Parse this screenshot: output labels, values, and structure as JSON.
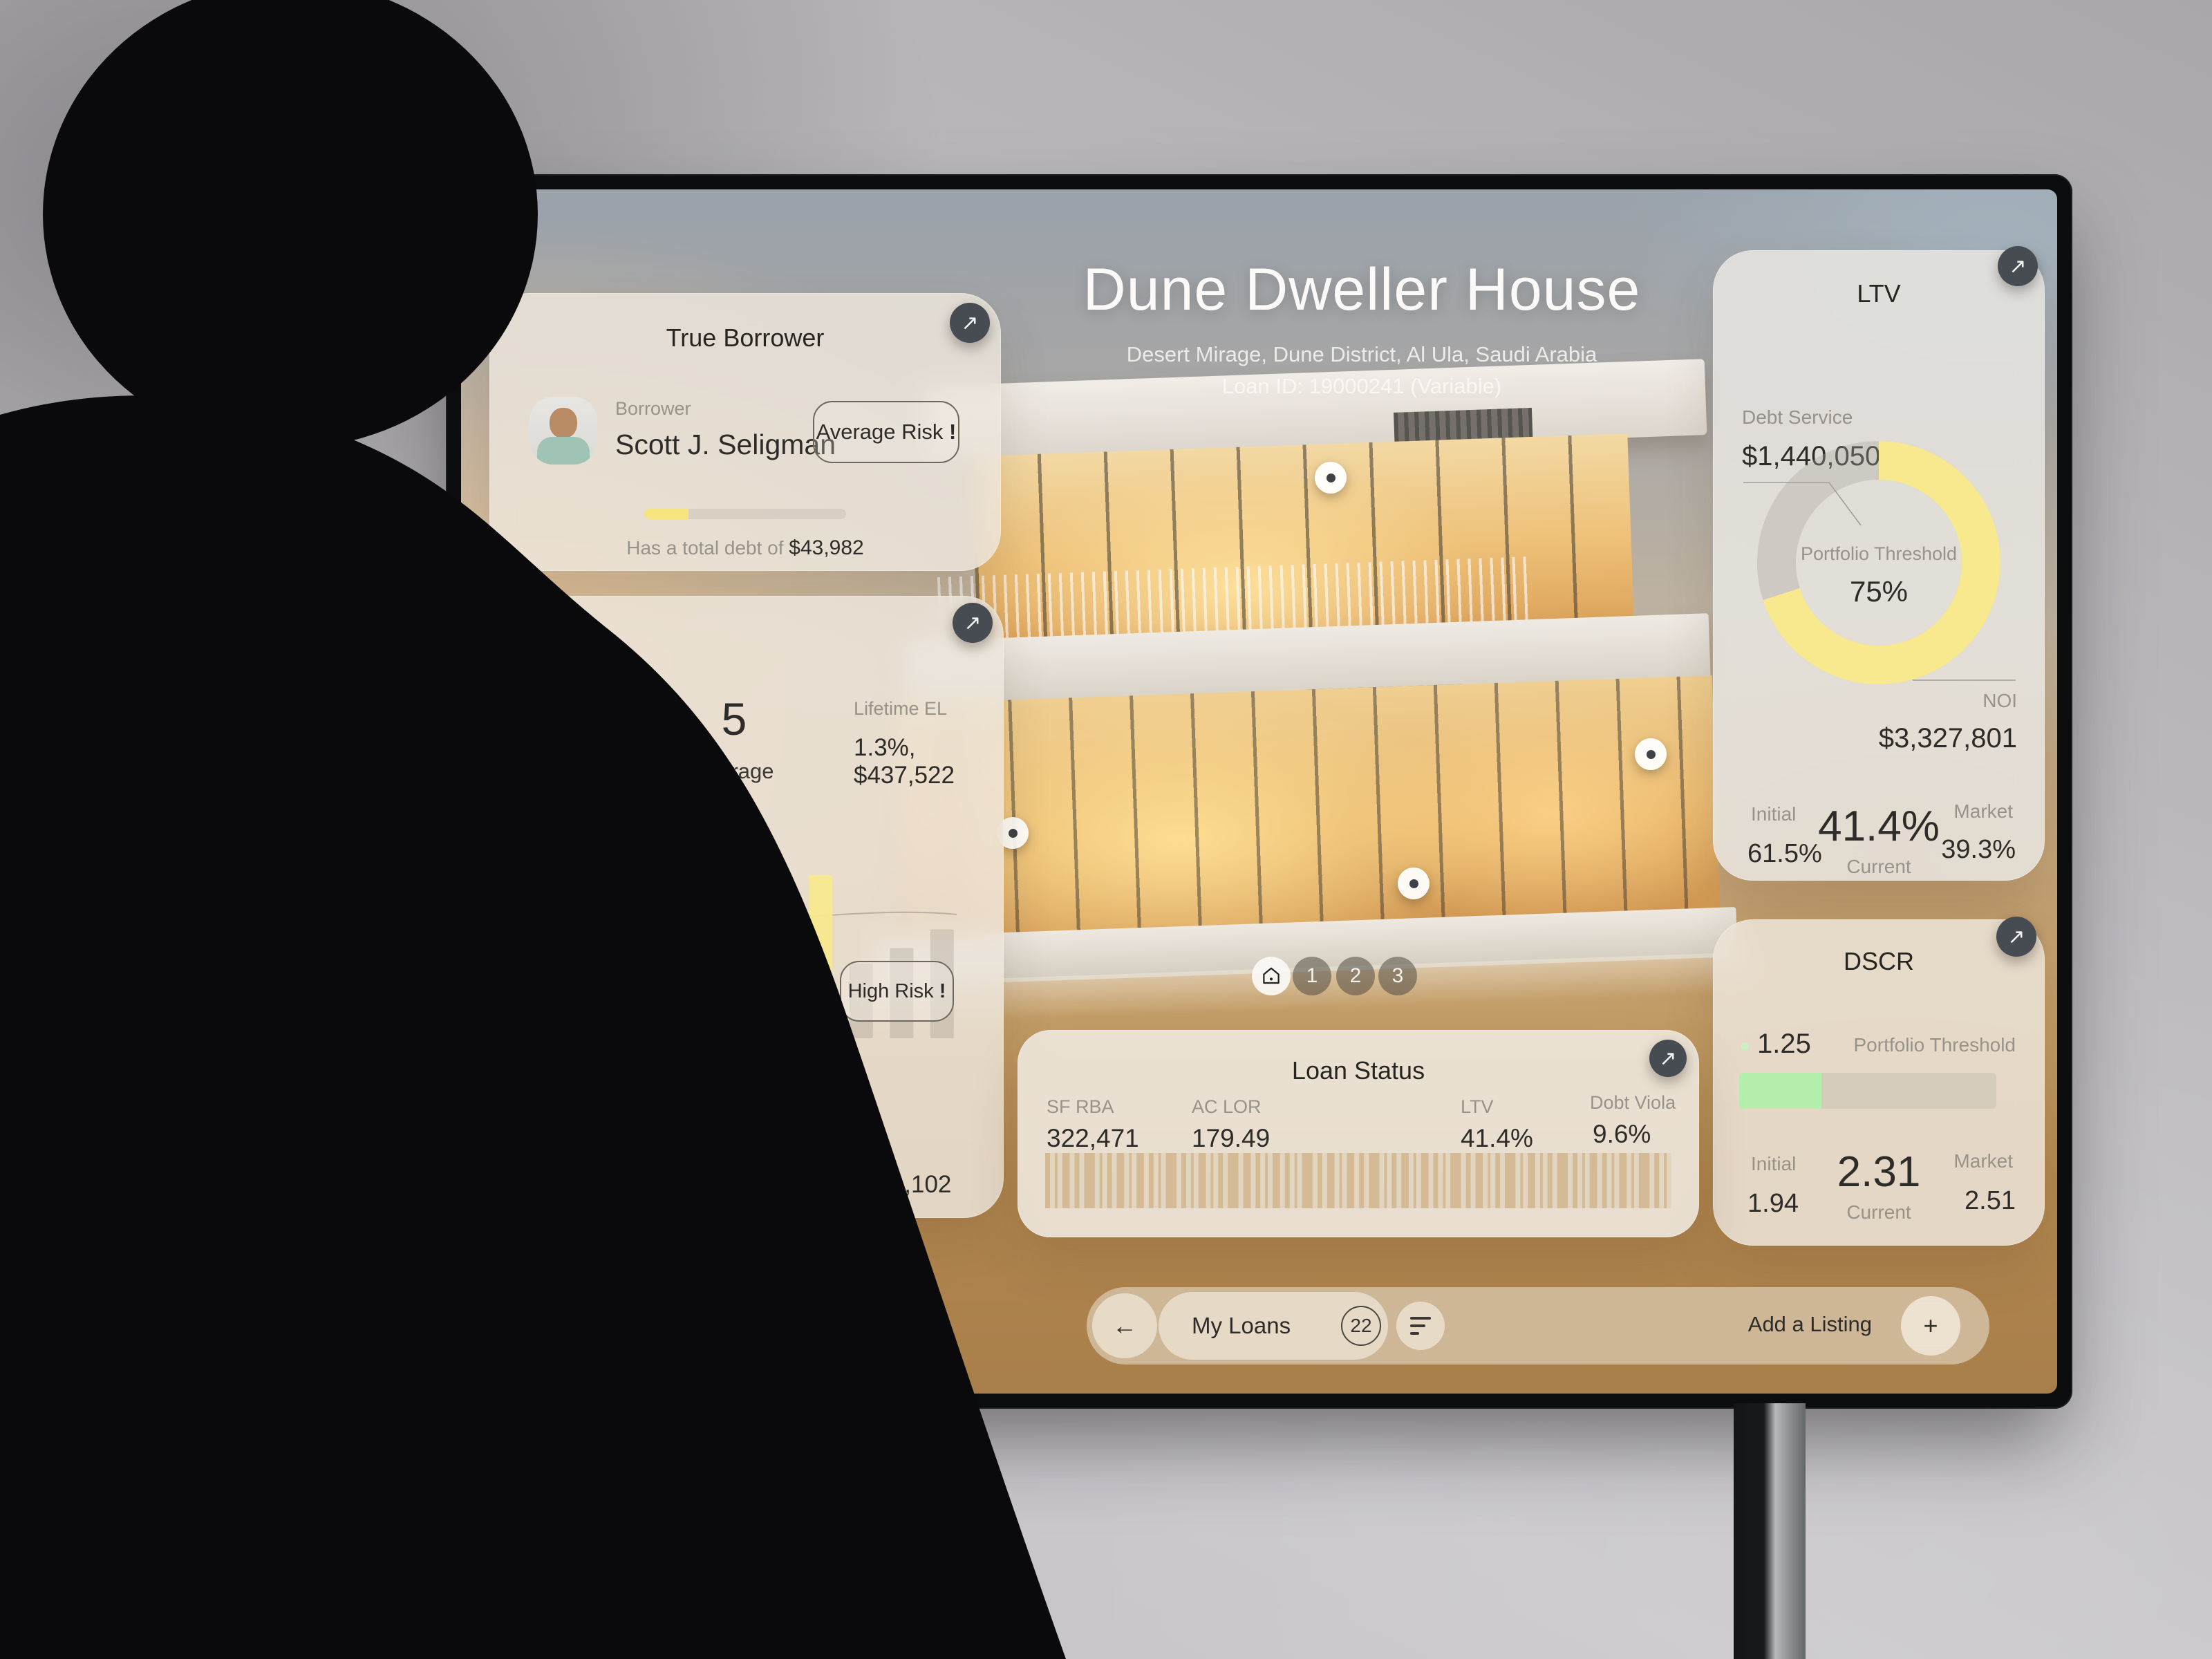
{
  "colors": {
    "accent_yellow": "#f8e88e",
    "accent_green": "#b5efae",
    "button_dark": "#474b52",
    "bar_gray": "#8e867a",
    "barcode_tan": "#c49c63"
  },
  "header": {
    "title": "Dune Dweller House",
    "address": "Desert Mirage, Dune District, Al Ula, Saudi Arabia",
    "loan_id": "Loan ID: 19000241 (Variable)"
  },
  "borrower_card": {
    "title": "True Borrower",
    "role_label": "Borrower",
    "name": "Scott J. Seligman",
    "risk_badge": "Average Risk",
    "risk_mark": "!",
    "progress_pct": 22,
    "debt_text_prefix": "Has a total debt of",
    "debt_value": "$43,982"
  },
  "risk_card": {
    "rating_label": "CoStar Risk Rating",
    "rating_value": "4 - Low",
    "score_value": "5",
    "score_label": "Average",
    "scenario_base_label": "Base Scenario",
    "lifetime_el_label": "Lifetime EL",
    "base_lifetime_el_value": "1.3%, $437,522",
    "high_risk_badge": "High Risk",
    "high_risk_mark": "!",
    "scenario_stress_label": "Stress Scenario",
    "stress_lifetime_el_label": "Lifetime EL",
    "stress_lifetime_el_value": "3.2%, $1,101,102"
  },
  "chart_data": {
    "type": "bar",
    "title": "Base Scenario loss distribution",
    "categories": [
      "1",
      "2",
      "3",
      "4",
      "5",
      "6",
      "7",
      "8",
      "9",
      "10"
    ],
    "values": [
      18,
      66,
      38,
      50,
      97,
      52,
      105,
      48,
      58,
      70
    ],
    "highlight_pct": [
      0,
      62,
      0,
      0,
      55,
      0,
      68,
      0,
      0,
      0
    ],
    "ylim": [
      0,
      100
    ],
    "annotations": [
      "High Risk !"
    ]
  },
  "ltv_card": {
    "title": "LTV",
    "debt_service_label": "Debt Service",
    "debt_service_value": "$1,440,050",
    "threshold_label": "Portfolio Threshold",
    "threshold_value": "75%",
    "donut_pct": 70,
    "noi_label": "NOI",
    "noi_value": "$3,327,801",
    "initial_label": "Initial",
    "initial_value": "61.5%",
    "current_value": "41.4%",
    "current_label": "Current",
    "market_label": "Market",
    "market_value": "39.3%"
  },
  "dscr_card": {
    "title": "DSCR",
    "current_marker_value": "1.25",
    "threshold_label": "Portfolio Threshold",
    "bar_pct": 32,
    "initial_label": "Initial",
    "initial_value": "1.94",
    "current_value": "2.31",
    "current_label": "Current",
    "market_label": "Market",
    "market_value": "2.51"
  },
  "loan_status_card": {
    "title": "Loan Status",
    "metrics": [
      {
        "label": "SF RBA",
        "value": "322,471"
      },
      {
        "label": "AC LOR",
        "value": "179.49"
      },
      {
        "label": "LTV",
        "value": "41.4%"
      },
      {
        "label": "Dobt Viola",
        "value": "9.6%"
      }
    ],
    "barcode_pattern": "213241231321421312432132142313241231321423124131242132131421"
  },
  "gallery": {
    "pages": [
      "1",
      "2",
      "3"
    ]
  },
  "bottom_bar": {
    "my_loans_label": "My Loans",
    "loan_count": "22",
    "add_listing_label": "Add a Listing"
  },
  "icons": {
    "expand": "↗",
    "back": "←",
    "plus": "+",
    "home": "house-outline",
    "filter": "sort-lines",
    "marker": "white-dot"
  }
}
